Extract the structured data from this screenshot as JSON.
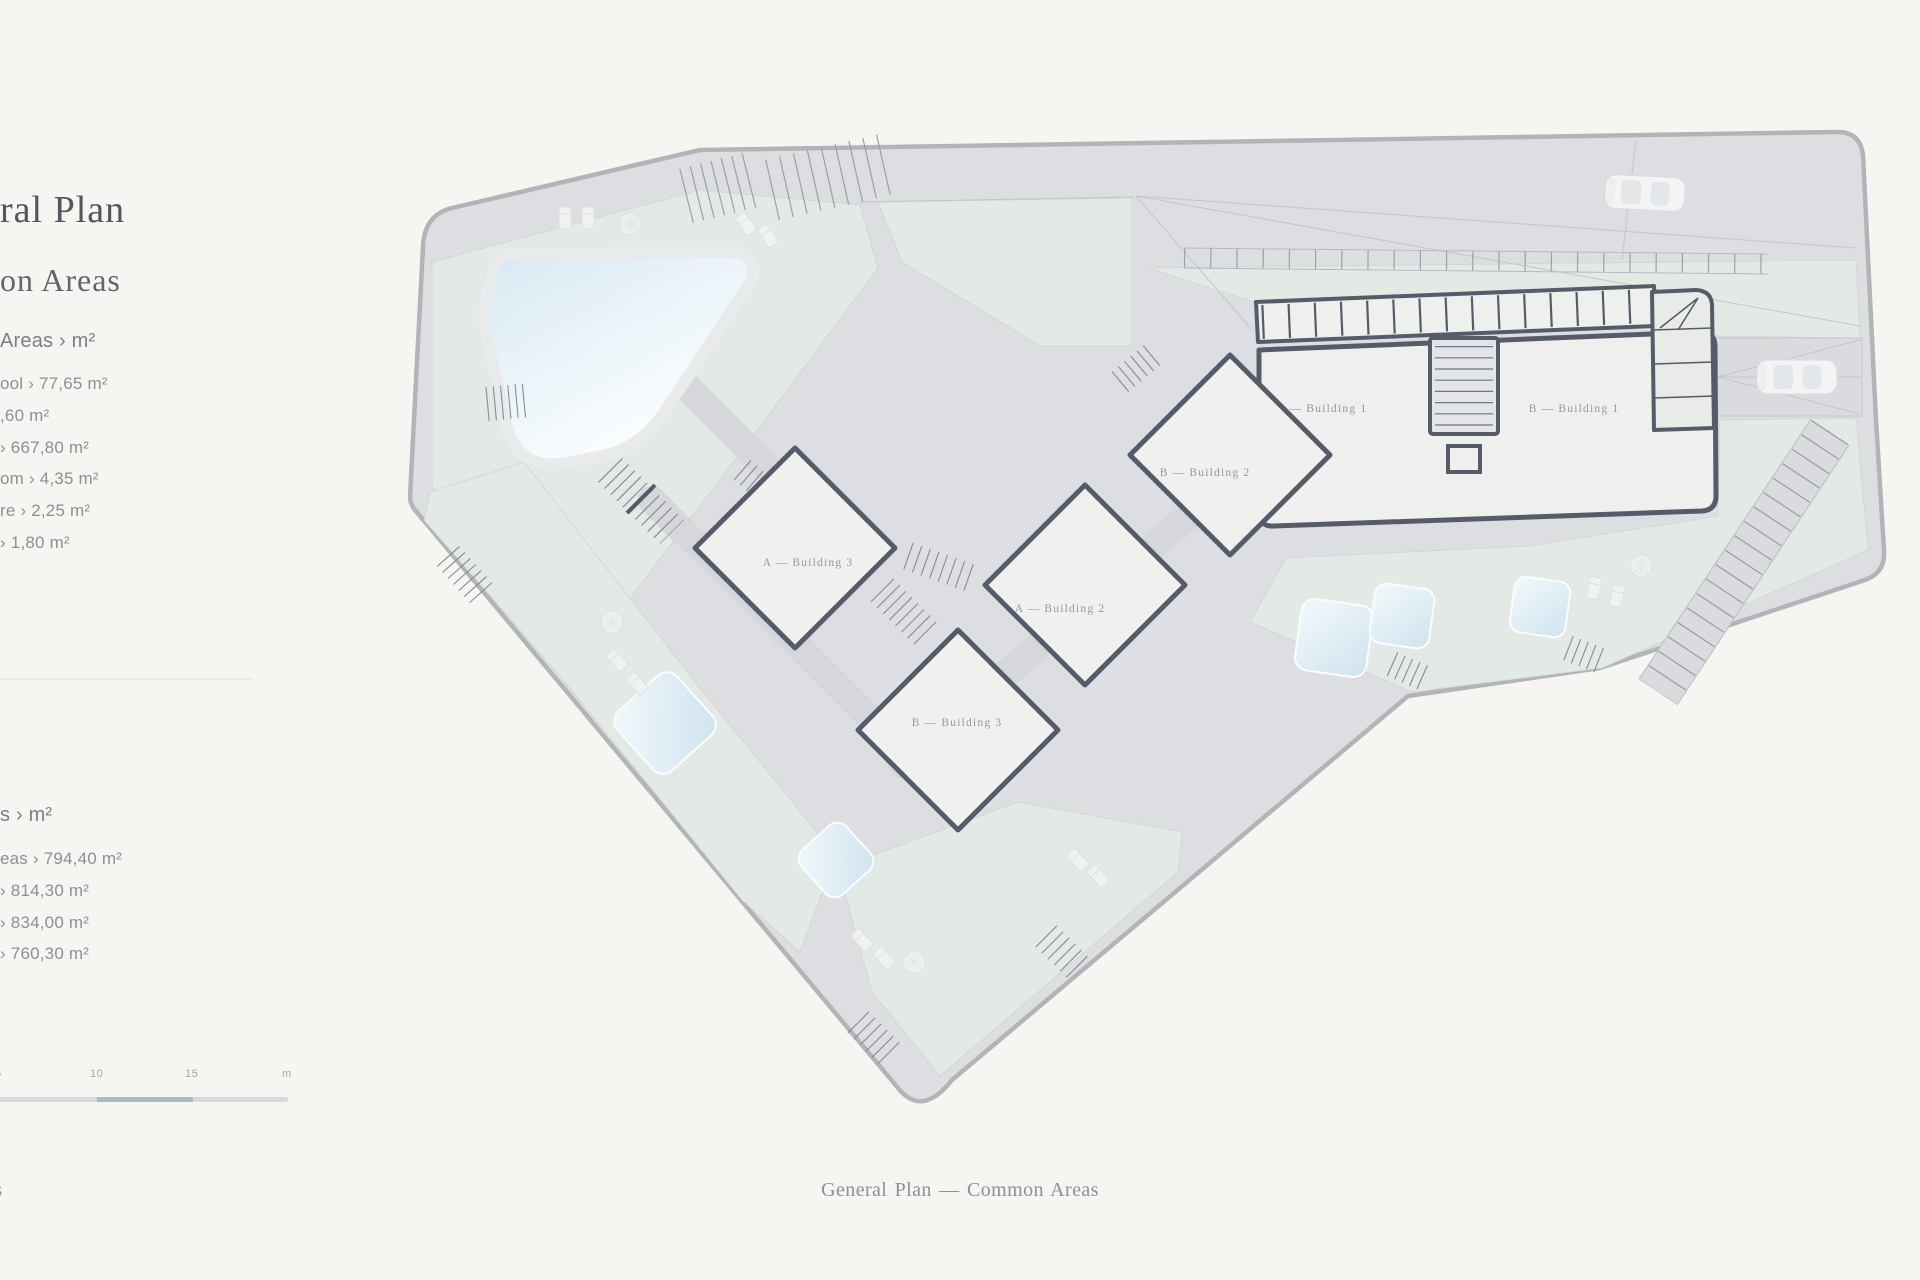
{
  "page": {
    "background": "#f7f5f1"
  },
  "sidebar": {
    "title_fragment": "ral Plan",
    "subtitle_fragment": "on Areas",
    "section_common": {
      "header": "Areas › m²",
      "items": [
        "ool › 77,65 m²",
        ",60 m²",
        "› 667,80 m²",
        "om › 4,35 m²",
        "re › 2,25 m²",
        "› 1,80 m²"
      ]
    },
    "section_plots": {
      "header": "s › m²",
      "items": [
        "eas › 794,40 m²",
        "› 814,30 m²",
        "› 834,00 m²",
        "› 760,30 m²"
      ]
    }
  },
  "scale_bar": {
    "labels": [
      "5",
      "10",
      "15",
      "m"
    ],
    "segment_light": "#d6d9da",
    "segment_dark": "#a8bbc6"
  },
  "captions": {
    "bottom_center": "General Plan — Common Areas",
    "bottom_left_fragment": "as"
  },
  "plan": {
    "building_labels": {
      "a1": "A — Building 1",
      "b1": "B — Building 1",
      "b2": "B — Building 2",
      "a2": "A — Building 2",
      "a3": "A — Building 3",
      "b3": "B — Building 3"
    },
    "colors": {
      "site_fill": "#dcdee1",
      "green": "#e3e9e4",
      "building_fill": "#f0f0ef",
      "wall": "#565b69",
      "boundary": "#b2b4b8",
      "pool_blue": "#cfe3ee"
    }
  }
}
